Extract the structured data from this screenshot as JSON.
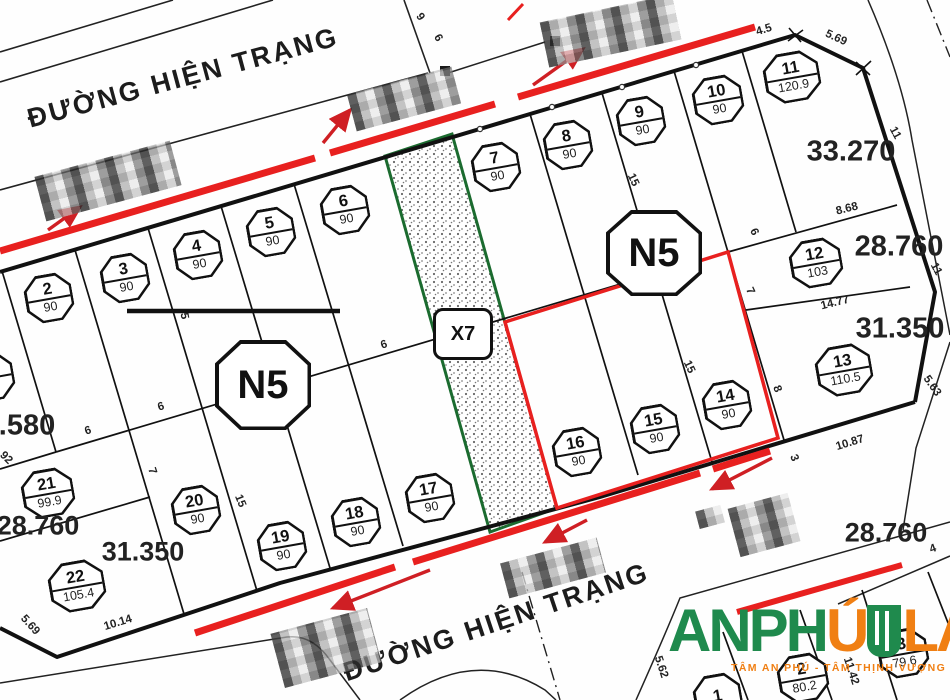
{
  "map": {
    "road_label_top": "ĐƯỜNG HIỆN TRẠNG",
    "road_label_bottom": "ĐƯỜNG HIỆN TRẠNG",
    "block_label": "N5",
    "strip_label": "X7",
    "colors": {
      "road_marking_red": "#e8201f",
      "strip_green": "#1b6b2f",
      "logo_green": "#1f8a4d",
      "logo_orange": "#f07f13",
      "line_black": "#111111"
    },
    "plots": [
      {
        "number": "1",
        "area": "90",
        "x": -10,
        "y": 377,
        "w": 48,
        "h": 48
      },
      {
        "number": "2",
        "area": "90",
        "x": 49,
        "y": 298,
        "w": 48,
        "h": 48
      },
      {
        "number": "3",
        "area": "90",
        "x": 125,
        "y": 278,
        "w": 48,
        "h": 48
      },
      {
        "number": "4",
        "area": "90",
        "x": 198,
        "y": 255,
        "w": 48,
        "h": 48
      },
      {
        "number": "5",
        "area": "90",
        "x": 271,
        "y": 232,
        "w": 48,
        "h": 48
      },
      {
        "number": "6",
        "area": "90",
        "x": 345,
        "y": 210,
        "w": 48,
        "h": 48
      },
      {
        "number": "7",
        "area": "90",
        "x": 496,
        "y": 167,
        "w": 48,
        "h": 48
      },
      {
        "number": "8",
        "area": "90",
        "x": 568,
        "y": 145,
        "w": 48,
        "h": 48
      },
      {
        "number": "9",
        "area": "90",
        "x": 641,
        "y": 121,
        "w": 48,
        "h": 48
      },
      {
        "number": "10",
        "area": "90",
        "x": 718,
        "y": 100,
        "w": 50,
        "h": 48
      },
      {
        "number": "11",
        "area": "120.9",
        "x": 792,
        "y": 77,
        "w": 56,
        "h": 50
      },
      {
        "number": "12",
        "area": "103",
        "x": 816,
        "y": 263,
        "w": 52,
        "h": 48
      },
      {
        "number": "13",
        "area": "110.5",
        "x": 844,
        "y": 370,
        "w": 56,
        "h": 50
      },
      {
        "number": "14",
        "area": "90",
        "x": 727,
        "y": 405,
        "w": 48,
        "h": 48
      },
      {
        "number": "15",
        "area": "90",
        "x": 655,
        "y": 429,
        "w": 48,
        "h": 48
      },
      {
        "number": "16",
        "area": "90",
        "x": 577,
        "y": 452,
        "w": 48,
        "h": 48
      },
      {
        "number": "17",
        "area": "90",
        "x": 430,
        "y": 498,
        "w": 48,
        "h": 48
      },
      {
        "number": "18",
        "area": "90",
        "x": 356,
        "y": 522,
        "w": 48,
        "h": 48
      },
      {
        "number": "19",
        "area": "90",
        "x": 282,
        "y": 546,
        "w": 48,
        "h": 48
      },
      {
        "number": "20",
        "area": "90",
        "x": 196,
        "y": 510,
        "w": 48,
        "h": 48
      },
      {
        "number": "21",
        "area": "99.9",
        "x": 48,
        "y": 493,
        "w": 52,
        "h": 48
      },
      {
        "number": "22",
        "area": "105.4",
        "x": 77,
        "y": 586,
        "w": 56,
        "h": 50
      },
      {
        "number": "1",
        "area": "",
        "x": 718,
        "y": 698,
        "w": 48,
        "h": 48
      },
      {
        "number": "2",
        "area": "80.2",
        "x": 803,
        "y": 678,
        "w": 50,
        "h": 48
      },
      {
        "number": "3",
        "area": "79.6",
        "x": 903,
        "y": 653,
        "w": 50,
        "h": 48
      }
    ],
    "area_labels": [
      {
        "text": "33.270",
        "x": 851,
        "y": 152,
        "fs": 29
      },
      {
        "text": "28.760",
        "x": 899,
        "y": 247,
        "fs": 29
      },
      {
        "text": "31.350",
        "x": 900,
        "y": 329,
        "fs": 29
      },
      {
        "text": "28.760",
        "x": 886,
        "y": 533,
        "fs": 27
      },
      {
        "text": ".580",
        "x": 27,
        "y": 426,
        "fs": 29
      },
      {
        "text": "28.760",
        "x": 38,
        "y": 526,
        "fs": 27
      },
      {
        "text": "31.350",
        "x": 143,
        "y": 552,
        "fs": 27
      }
    ],
    "dimensions": [
      {
        "text": "4.5",
        "x": 764,
        "y": 30,
        "rot": -17
      },
      {
        "text": "5.69",
        "x": 836,
        "y": 38,
        "rot": 25
      },
      {
        "text": "9",
        "x": 420,
        "y": 17,
        "rot": 55
      },
      {
        "text": "6",
        "x": 438,
        "y": 38,
        "rot": 60
      },
      {
        "text": "15",
        "x": 633,
        "y": 180,
        "rot": 65
      },
      {
        "text": "8.68",
        "x": 847,
        "y": 209,
        "rot": -14
      },
      {
        "text": "11",
        "x": 895,
        "y": 133,
        "rot": 62
      },
      {
        "text": "11",
        "x": 936,
        "y": 269,
        "rot": 62
      },
      {
        "text": "14.77",
        "x": 835,
        "y": 303,
        "rot": -14
      },
      {
        "text": "6",
        "x": 754,
        "y": 232,
        "rot": 65
      },
      {
        "text": "7",
        "x": 750,
        "y": 291,
        "rot": 65
      },
      {
        "text": "8",
        "x": 777,
        "y": 389,
        "rot": 68
      },
      {
        "text": "3",
        "x": 794,
        "y": 458,
        "rot": 68
      },
      {
        "text": "10.87",
        "x": 850,
        "y": 443,
        "rot": -17
      },
      {
        "text": "5.63",
        "x": 932,
        "y": 386,
        "rot": 55
      },
      {
        "text": "4",
        "x": 933,
        "y": 549,
        "rot": -20
      },
      {
        "text": "15",
        "x": 689,
        "y": 367,
        "rot": 65
      },
      {
        "text": "6",
        "x": 384,
        "y": 345,
        "rot": -17
      },
      {
        "text": "6",
        "x": 88,
        "y": 431,
        "rot": -17
      },
      {
        "text": "6",
        "x": 161,
        "y": 407,
        "rot": -17
      },
      {
        "text": "7",
        "x": 152,
        "y": 471,
        "rot": 72
      },
      {
        "text": "15",
        "x": 240,
        "y": 501,
        "rot": 68
      },
      {
        "text": "5",
        "x": 184,
        "y": 316,
        "rot": 80
      },
      {
        "text": "92",
        "x": 6,
        "y": 458,
        "rot": 45
      },
      {
        "text": "5.69",
        "x": 30,
        "y": 625,
        "rot": 48
      },
      {
        "text": "10.14",
        "x": 118,
        "y": 623,
        "rot": -17
      },
      {
        "text": "5.62",
        "x": 661,
        "y": 667,
        "rot": 72
      },
      {
        "text": "11.42",
        "x": 851,
        "y": 671,
        "rot": 72
      }
    ],
    "n5_positions": [
      {
        "x": 263,
        "y": 385,
        "w": 96,
        "h": 90
      },
      {
        "x": 654,
        "y": 253,
        "w": 96,
        "h": 86
      }
    ],
    "x7_position": {
      "x": 463,
      "y": 334
    }
  },
  "logo": {
    "part1": "ANPH",
    "accent": "Ú",
    "part2": "LA",
    "tagline": "TÂM AN PHÚ - TÂM THỊNH VƯỢNG"
  }
}
